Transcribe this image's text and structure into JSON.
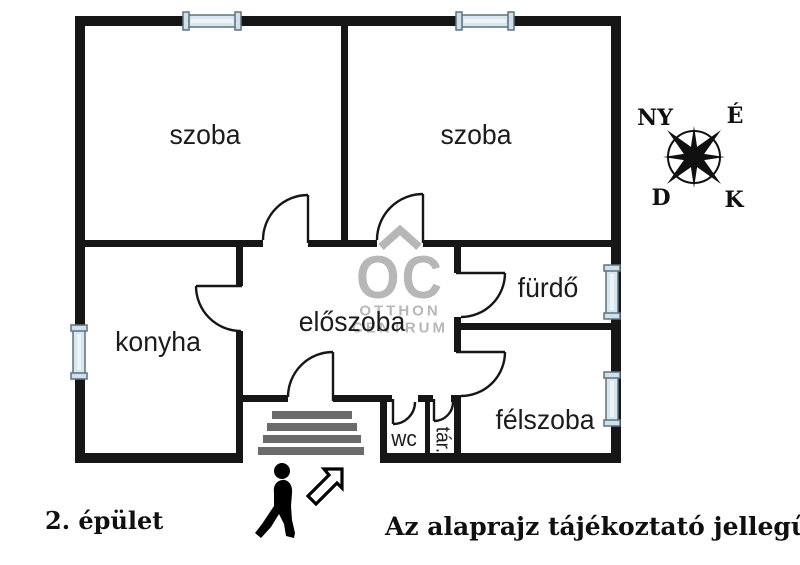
{
  "plan": {
    "rooms": [
      {
        "id": "szoba-left",
        "label": "szoba"
      },
      {
        "id": "szoba-right",
        "label": "szoba"
      },
      {
        "id": "konyha",
        "label": "konyha"
      },
      {
        "id": "eloszoba",
        "label": "előszoba"
      },
      {
        "id": "furdo",
        "label": "fürdő"
      },
      {
        "id": "felszoba",
        "label": "félszoba"
      },
      {
        "id": "wc",
        "label": "wc"
      },
      {
        "id": "tar",
        "label": "tár."
      }
    ]
  },
  "watermark": {
    "logo": "OC",
    "line1": "OTTHON",
    "line2": "CENTRUM"
  },
  "compass": {
    "top_left": "NY",
    "top_right": "É",
    "bottom_left": "D",
    "bottom_right": "K"
  },
  "captions": {
    "building": "2. épület",
    "disclaimer": "Az alaprajz tájékoztató jellegű"
  },
  "icons": {
    "compass": "compass-rose-icon",
    "person": "walking-person-icon",
    "entrance_arrow": "arrow-up-right-icon",
    "window": "window-icon",
    "door": "door-swing-arc-icon",
    "stairs": "stairs-icon",
    "roof": "house-roof-icon"
  },
  "colors": {
    "wall": "#161616",
    "window_fill": "#d7e7ef",
    "window_frame": "#5e707c",
    "stairs": "#6b6b6b",
    "watermark": "#b7b7b7",
    "text": "#1c1c1c"
  }
}
